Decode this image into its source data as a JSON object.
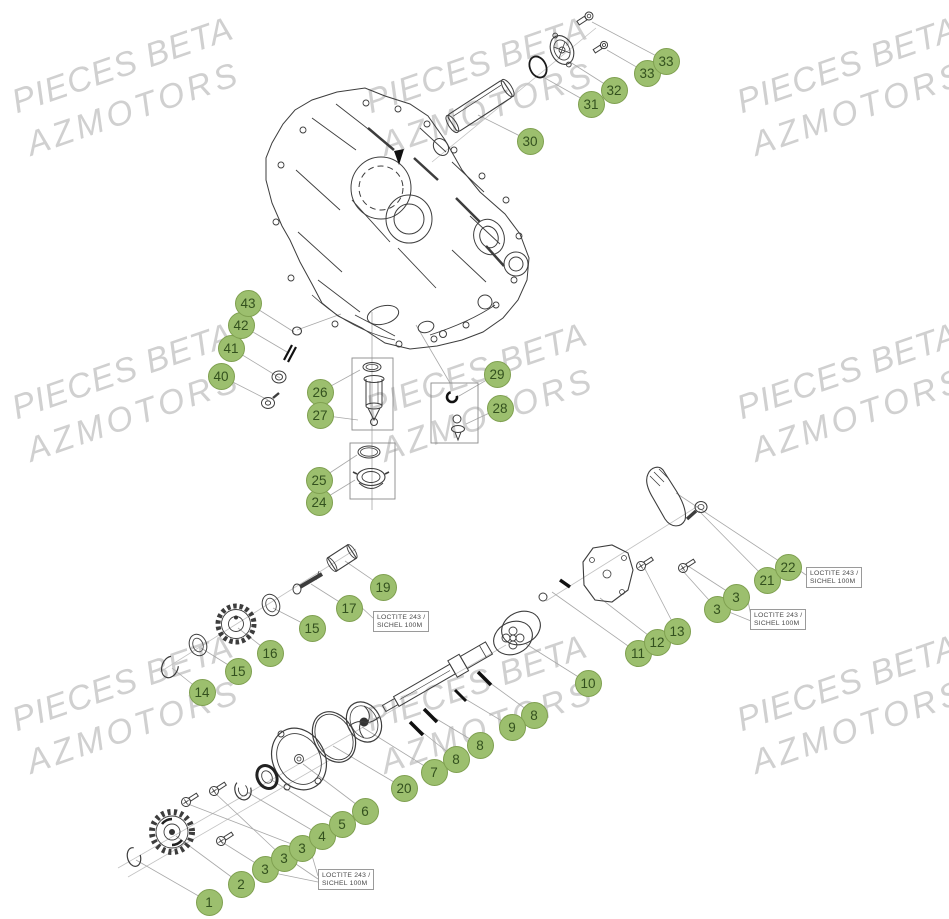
{
  "watermark": {
    "line1": "PIECES BETA",
    "line2": "AZMOTORS",
    "color": "#d0d0d0",
    "positions": [
      {
        "x": 130,
        "y": 87
      },
      {
        "x": 484,
        "y": 87
      },
      {
        "x": 855,
        "y": 87
      },
      {
        "x": 130,
        "y": 393
      },
      {
        "x": 484,
        "y": 393
      },
      {
        "x": 855,
        "y": 393
      },
      {
        "x": 130,
        "y": 705
      },
      {
        "x": 484,
        "y": 705
      },
      {
        "x": 855,
        "y": 705
      }
    ]
  },
  "callouts": {
    "style": {
      "fill": "#9cbf6e",
      "border": "#7fa050",
      "text_color": "#33511e"
    },
    "items": [
      {
        "label": "1",
        "x": 209,
        "y": 902
      },
      {
        "label": "2",
        "x": 241,
        "y": 884
      },
      {
        "label": "3",
        "x": 265,
        "y": 869
      },
      {
        "label": "3",
        "x": 284,
        "y": 858
      },
      {
        "label": "3",
        "x": 302,
        "y": 848
      },
      {
        "label": "4",
        "x": 322,
        "y": 836
      },
      {
        "label": "5",
        "x": 342,
        "y": 824
      },
      {
        "label": "6",
        "x": 365,
        "y": 811
      },
      {
        "label": "7",
        "x": 434,
        "y": 772
      },
      {
        "label": "8",
        "x": 456,
        "y": 759
      },
      {
        "label": "8",
        "x": 480,
        "y": 745
      },
      {
        "label": "8",
        "x": 534,
        "y": 715
      },
      {
        "label": "9",
        "x": 512,
        "y": 727
      },
      {
        "label": "10",
        "x": 588,
        "y": 683
      },
      {
        "label": "11",
        "x": 638,
        "y": 653
      },
      {
        "label": "12",
        "x": 657,
        "y": 642
      },
      {
        "label": "13",
        "x": 677,
        "y": 631
      },
      {
        "label": "14",
        "x": 202,
        "y": 692
      },
      {
        "label": "15",
        "x": 238,
        "y": 671
      },
      {
        "label": "16",
        "x": 270,
        "y": 653
      },
      {
        "label": "15",
        "x": 312,
        "y": 628
      },
      {
        "label": "17",
        "x": 349,
        "y": 608
      },
      {
        "label": "19",
        "x": 383,
        "y": 587
      },
      {
        "label": "20",
        "x": 404,
        "y": 788
      },
      {
        "label": "3",
        "x": 717,
        "y": 609
      },
      {
        "label": "3",
        "x": 736,
        "y": 597
      },
      {
        "label": "21",
        "x": 767,
        "y": 580
      },
      {
        "label": "22",
        "x": 788,
        "y": 567
      },
      {
        "label": "24",
        "x": 319,
        "y": 502
      },
      {
        "label": "25",
        "x": 319,
        "y": 480
      },
      {
        "label": "26",
        "x": 320,
        "y": 392
      },
      {
        "label": "27",
        "x": 320,
        "y": 415
      },
      {
        "label": "28",
        "x": 500,
        "y": 408
      },
      {
        "label": "29",
        "x": 497,
        "y": 374
      },
      {
        "label": "30",
        "x": 530,
        "y": 141
      },
      {
        "label": "31",
        "x": 591,
        "y": 104
      },
      {
        "label": "32",
        "x": 614,
        "y": 90
      },
      {
        "label": "33",
        "x": 647,
        "y": 73
      },
      {
        "label": "33",
        "x": 666,
        "y": 61
      },
      {
        "label": "40",
        "x": 221,
        "y": 376
      },
      {
        "label": "41",
        "x": 231,
        "y": 348
      },
      {
        "label": "42",
        "x": 241,
        "y": 325
      },
      {
        "label": "43",
        "x": 248,
        "y": 303
      }
    ]
  },
  "notes": {
    "line1": "LOCTITE 243 /",
    "line2": "SICHEL 100M",
    "positions": [
      {
        "x": 806,
        "y": 567
      },
      {
        "x": 750,
        "y": 609
      },
      {
        "x": 373,
        "y": 611
      },
      {
        "x": 318,
        "y": 869
      }
    ]
  }
}
